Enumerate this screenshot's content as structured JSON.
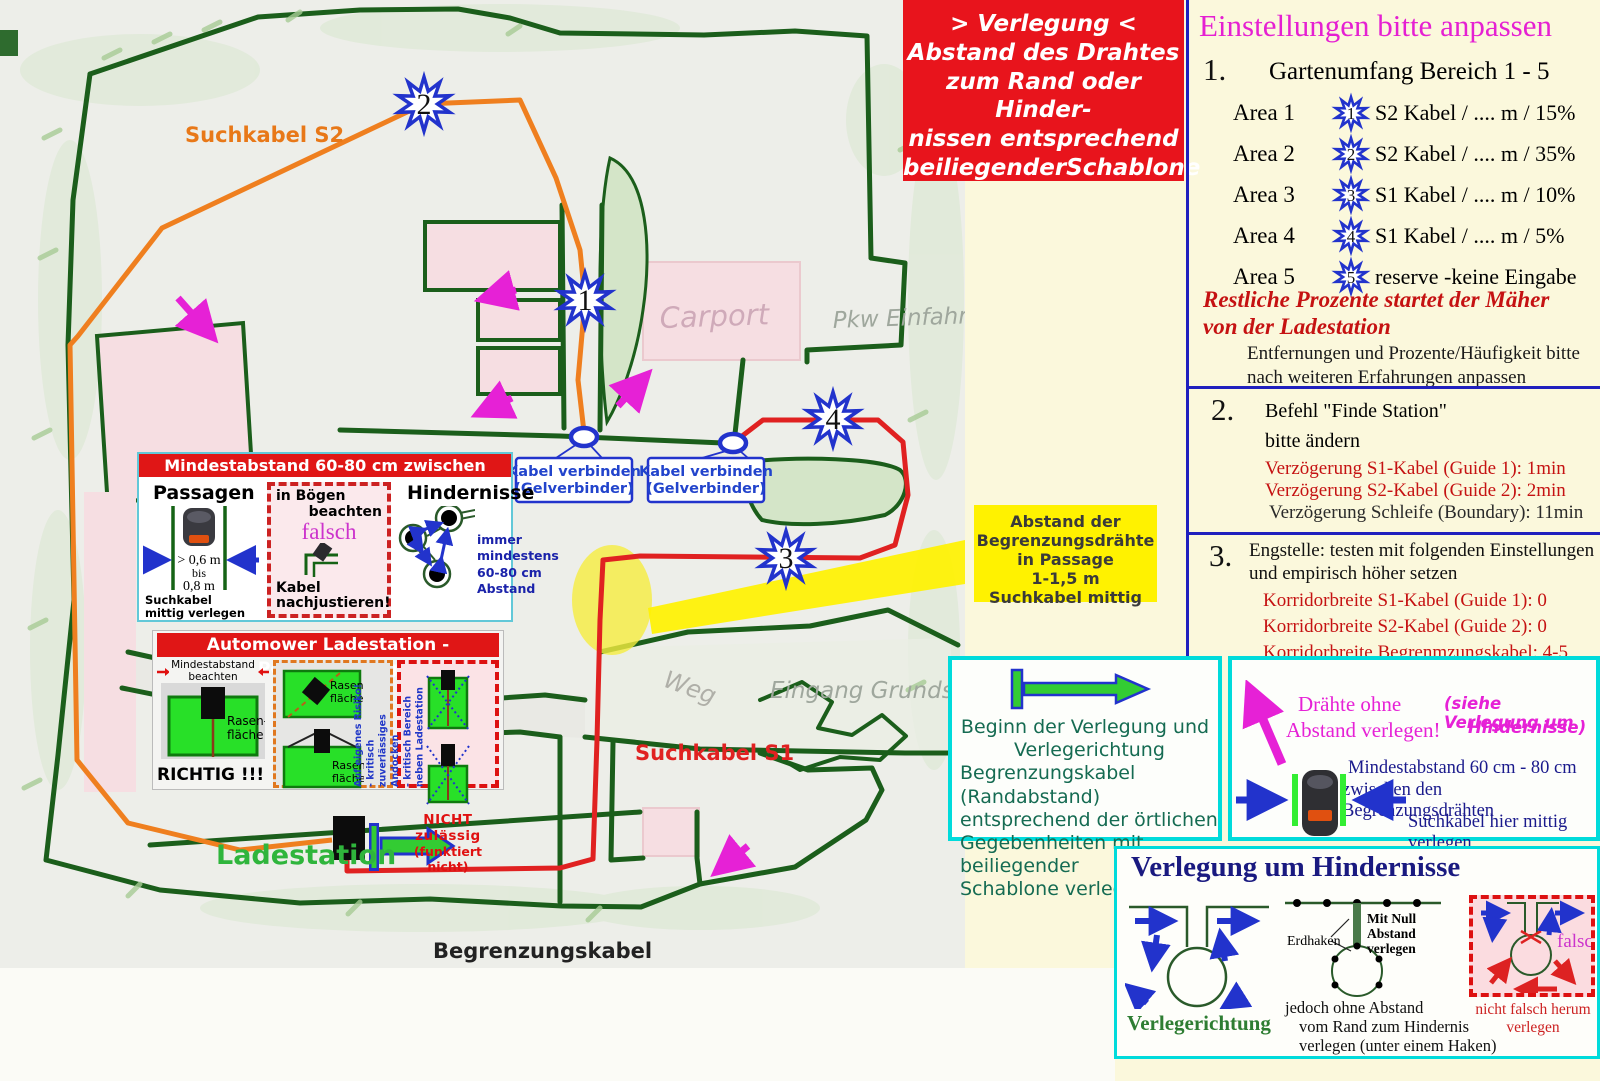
{
  "notice": {
    "l1": "> Verlegung <",
    "l2": "Abstand des Drahtes",
    "l3": "zum Rand oder Hinder-",
    "l4": "nissen entsprechend",
    "l5": "beiliegenderSchablone"
  },
  "settings": {
    "title": "Einstellungen bitte anpassen",
    "s1_num": "1.",
    "s1_title": "Gartenumfang Bereich 1 - 5",
    "areas": [
      {
        "label": "Area 1",
        "marker": "1",
        "text": "S2 Kabel / .... m / 15%"
      },
      {
        "label": "Area 2",
        "marker": "2",
        "text": "S2 Kabel / .... m / 35%"
      },
      {
        "label": "Area 3",
        "marker": "3",
        "text": "S1 Kabel / .... m / 10%"
      },
      {
        "label": "Area 4",
        "marker": "4",
        "text": "S1 Kabel / .... m / 5%"
      },
      {
        "label": "Area 5",
        "marker": "5",
        "text": "reserve -keine Eingabe"
      }
    ],
    "note_red_1": "Restliche Prozente  startet der Mäher",
    "note_red_2": "von der Ladestation",
    "note_plain_1": "Entfernungen und Prozente/Häufigkeit bitte",
    "note_plain_2": "nach weiteren Erfahrungen anpassen",
    "s2_num": "2.",
    "s2_title": "Befehl \"Finde Station\"",
    "s2_sub": "bitte ändern",
    "s2_red1": "Verzögerung S1-Kabel (Guide 1): 1min",
    "s2_red2": "Verzögerung S2-Kabel (Guide 2): 2min",
    "s2_plain": "Verzögerung Schleife (Boundary): 11min",
    "s3_num": "3.",
    "s3_title_1": "Engstelle: testen mit folgenden Einstellungen",
    "s3_title_2": "und empirisch höher setzen",
    "s3_red1": "Korridorbreite S1-Kabel (Guide 1): 0",
    "s3_red2": "Korridorbreite S2-Kabel (Guide 2): 0",
    "s3_red3": "Korridorbreite Begrenmzungskabel: 4-5"
  },
  "map": {
    "suchkabel_s2": "Suchkabel S2",
    "suchkabel_s1": "Suchkabel S1",
    "begrenzungskabel": "Begrenzungskabel",
    "ladestation": "Ladestation",
    "carport": "Carport",
    "pkw_einfahrt": "Pkw Einfahrt",
    "weg": "Weg",
    "eingang": "Eingang Grundstück",
    "connector1_l1": "Kabel verbinden",
    "connector1_l2": "(Gelverbinder)",
    "connector2_l1": "Kabel verbinden",
    "connector2_l2": "(Gelverbinder)",
    "markers": [
      {
        "n": "2"
      },
      {
        "n": "1"
      },
      {
        "n": "4"
      },
      {
        "n": "3"
      }
    ]
  },
  "yellow_note": {
    "l1": "Abstand der",
    "l2": "Begrenzungsdrähte",
    "l3": "in Passage",
    "l4": "1-1,5 m",
    "l5": "Suchkabel mittig"
  },
  "panel_abstand": {
    "header": "Mindestabstand 60-80 cm zwischen Begrenzungsdrähten",
    "passagen_title": "Passagen",
    "d1": "> 0,6 m",
    "d2": "bis",
    "d3": "0,8 m",
    "foot1": "Suchkabel",
    "foot2": "mittig verlegen",
    "boegen_l1": "in Bögen",
    "boegen_l2": "beachten",
    "falsch": "falsch",
    "boegen_f1": "Kabel",
    "boegen_f2": "nachjustieren!",
    "hind_title": "Hindernisse",
    "hind_t1": "immer",
    "hind_t2": "mindestens",
    "hind_t3": "60-80 cm",
    "hind_t4": "Abstand"
  },
  "panel_station": {
    "header": "Automower Ladestation - Positionierung",
    "min1": "Mindestabstand",
    "min2": "beachten",
    "rasen1": "Rasen-",
    "rasen2": "fläche",
    "richtig": "RICHTIG !!!",
    "mid_rasen1a": "Rasen-",
    "mid_rasen1b": "fläche",
    "mid_rasen2a": "Rasen-",
    "mid_rasen2b": "fläche",
    "risk1": "Auf eigenes Risiko!",
    "risk2": "- kritisch zuverlässiges Andocken",
    "risk3": "- kritisch Bereich neben Ladestation",
    "nicht1": "NICHT zulässig",
    "nicht2": "(funktiert nicht)"
  },
  "box_beginn": {
    "l1": "Beginn der Verlegung und",
    "l2": "Verlegerichtung",
    "l3": "Begrenzungskabel (Randabstand)",
    "l4": "entsprechend der örtlichen",
    "l5": "Gegebenheiten mit beiliegender",
    "l6": "Schablone verlegen"
  },
  "box_draehte": {
    "m1": "Drähte ohne",
    "m2": "Abstand verlegen!",
    "s1": "(siehe Verlegung um",
    "s2": "Hindernisse)",
    "b1": "Mindestabstand 60 cm - 80 cm",
    "b2": "zwischen den Begrenzungsdrähten",
    "b3": "Suchkabel hier mittig verlegen"
  },
  "box_hindernisse": {
    "title": "Verlegung um Hindernisse",
    "verlegerichtung": "Verlegerichtung",
    "erdhaken": "Erdhaken",
    "null1": "Mit Null",
    "null2": "Abstand",
    "null3": "verlegen",
    "cap1": "jedoch ohne Abstand",
    "cap2": "vom Rand zum Hindernis",
    "cap3": "verlegen (unter einem Haken)",
    "falsch": "falsch",
    "f1": "nicht falsch herum",
    "f2": "verlegen"
  },
  "colors": {
    "boundary": "#1B5E1B",
    "suchkabel_s1": "#E02121",
    "suchkabel_s2": "#EF7F1F",
    "accent_cyan": "#00DBDB",
    "magenta": "#E621D6",
    "note_yellow": "#FFF200"
  }
}
